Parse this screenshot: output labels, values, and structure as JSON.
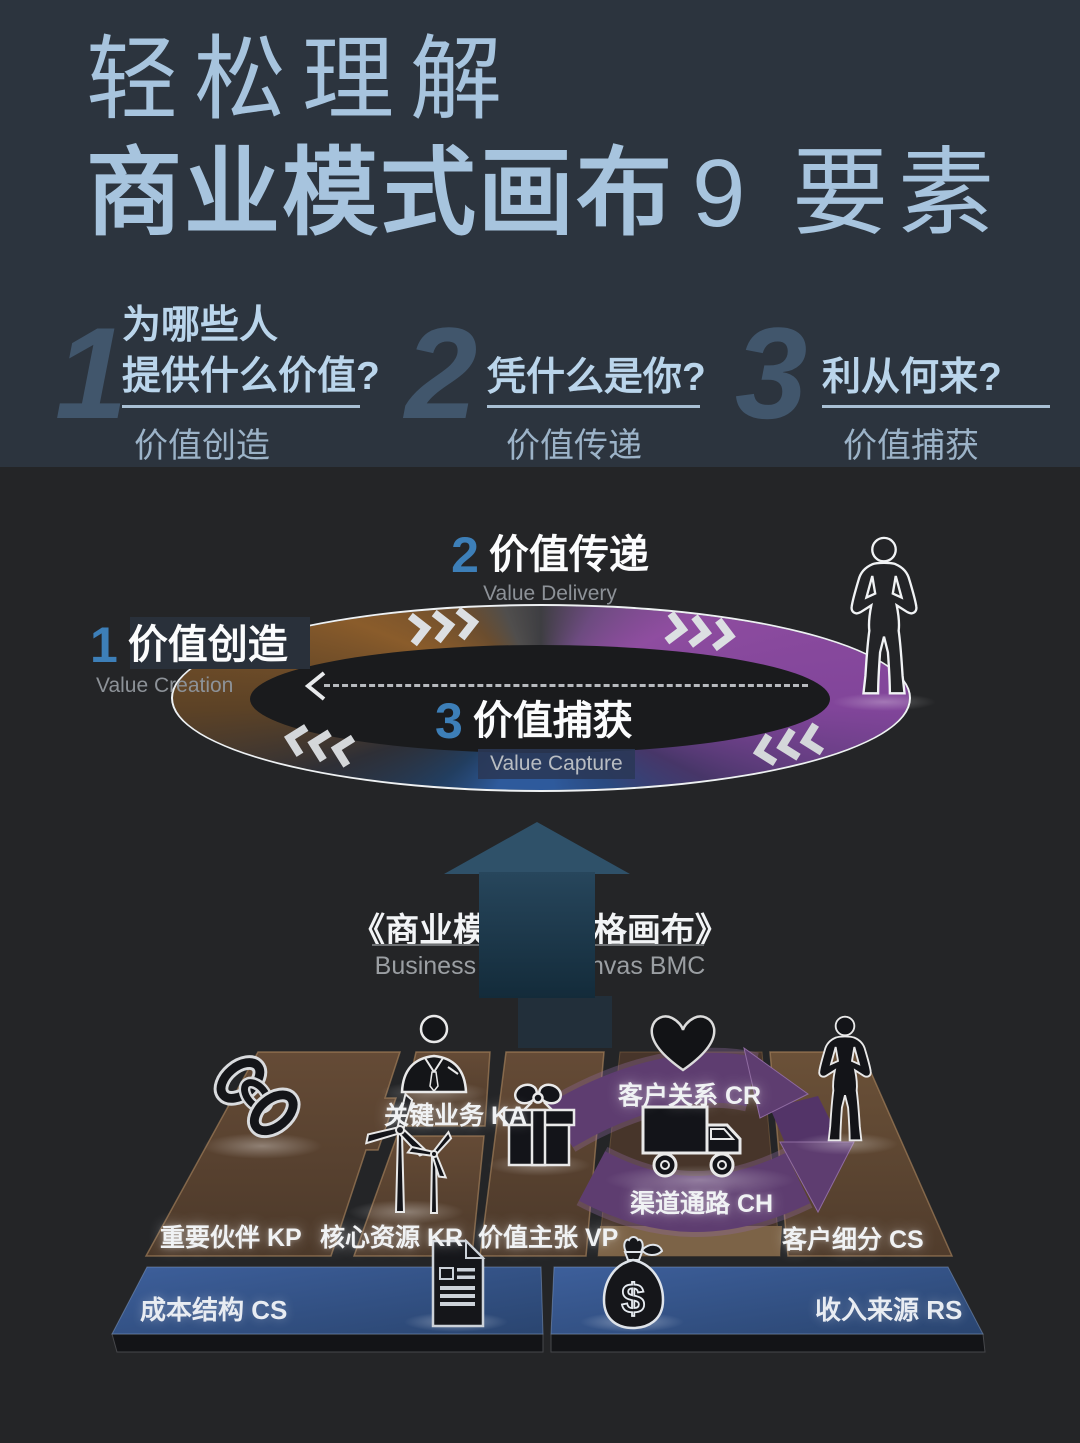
{
  "colors": {
    "header_bg": "#2c343e",
    "body_bg": "#242527",
    "title_blue": "#a7c4de",
    "question_blue": "#bad5eb",
    "big_number_slate": "#41566c",
    "cycle_number_blue": "#3d7fb8",
    "ring_purple": "#8f4da0",
    "ring_blue": "#2e5a9c",
    "ring_amber": "#8a5c2b",
    "up_arrow_teal": "#2f5169",
    "board_brown": "#5a4330",
    "arrow_band_purple": "#5e3d70",
    "bar_blue": "#33558c"
  },
  "header": {
    "title_line1": "轻松理解",
    "title_bold": "商业模式画布",
    "title_light": "9 要素",
    "items": [
      {
        "num": "1",
        "line1": "为哪些人",
        "line2": "提供什么价值?",
        "label": "价值创造"
      },
      {
        "num": "2",
        "line1": "凭什么是你?",
        "line2": "",
        "label": "价值传递"
      },
      {
        "num": "3",
        "line1": "利从何来?",
        "line2": "",
        "label": "价值捕获"
      }
    ]
  },
  "cycle": {
    "top": {
      "num": "2",
      "zh": "价值传递",
      "en": "Value Delivery"
    },
    "left": {
      "num": "1",
      "zh": "价值创造",
      "en": "Value Creation"
    },
    "bottom": {
      "num": "3",
      "zh": "价值捕获",
      "en": "Value Capture"
    }
  },
  "bmc": {
    "zh": "《商业模式 9 宫格画布》",
    "en": "Business Model Canvas BMC"
  },
  "board": {
    "kp": {
      "label": "重要伙伴 KP",
      "icon": "chain-icon"
    },
    "ka": {
      "label": "关键业务 KA",
      "icon": "businessman-icon"
    },
    "kr": {
      "label": "核心资源 KR",
      "icon": "wind-turbine-icon"
    },
    "vp": {
      "label": "价值主张 VP",
      "icon": "gift-icon"
    },
    "cr": {
      "label": "客户关系 CR",
      "icon": "heart-icon"
    },
    "ch": {
      "label": "渠道通路 CH",
      "icon": "truck-icon"
    },
    "cs": {
      "label": "客户细分 CS",
      "icon": "person-icon"
    },
    "cost": {
      "label": "成本结构 CS",
      "icon": "document-icon"
    },
    "rs": {
      "label": "收入来源 RS",
      "icon": "money-bag-icon"
    }
  }
}
